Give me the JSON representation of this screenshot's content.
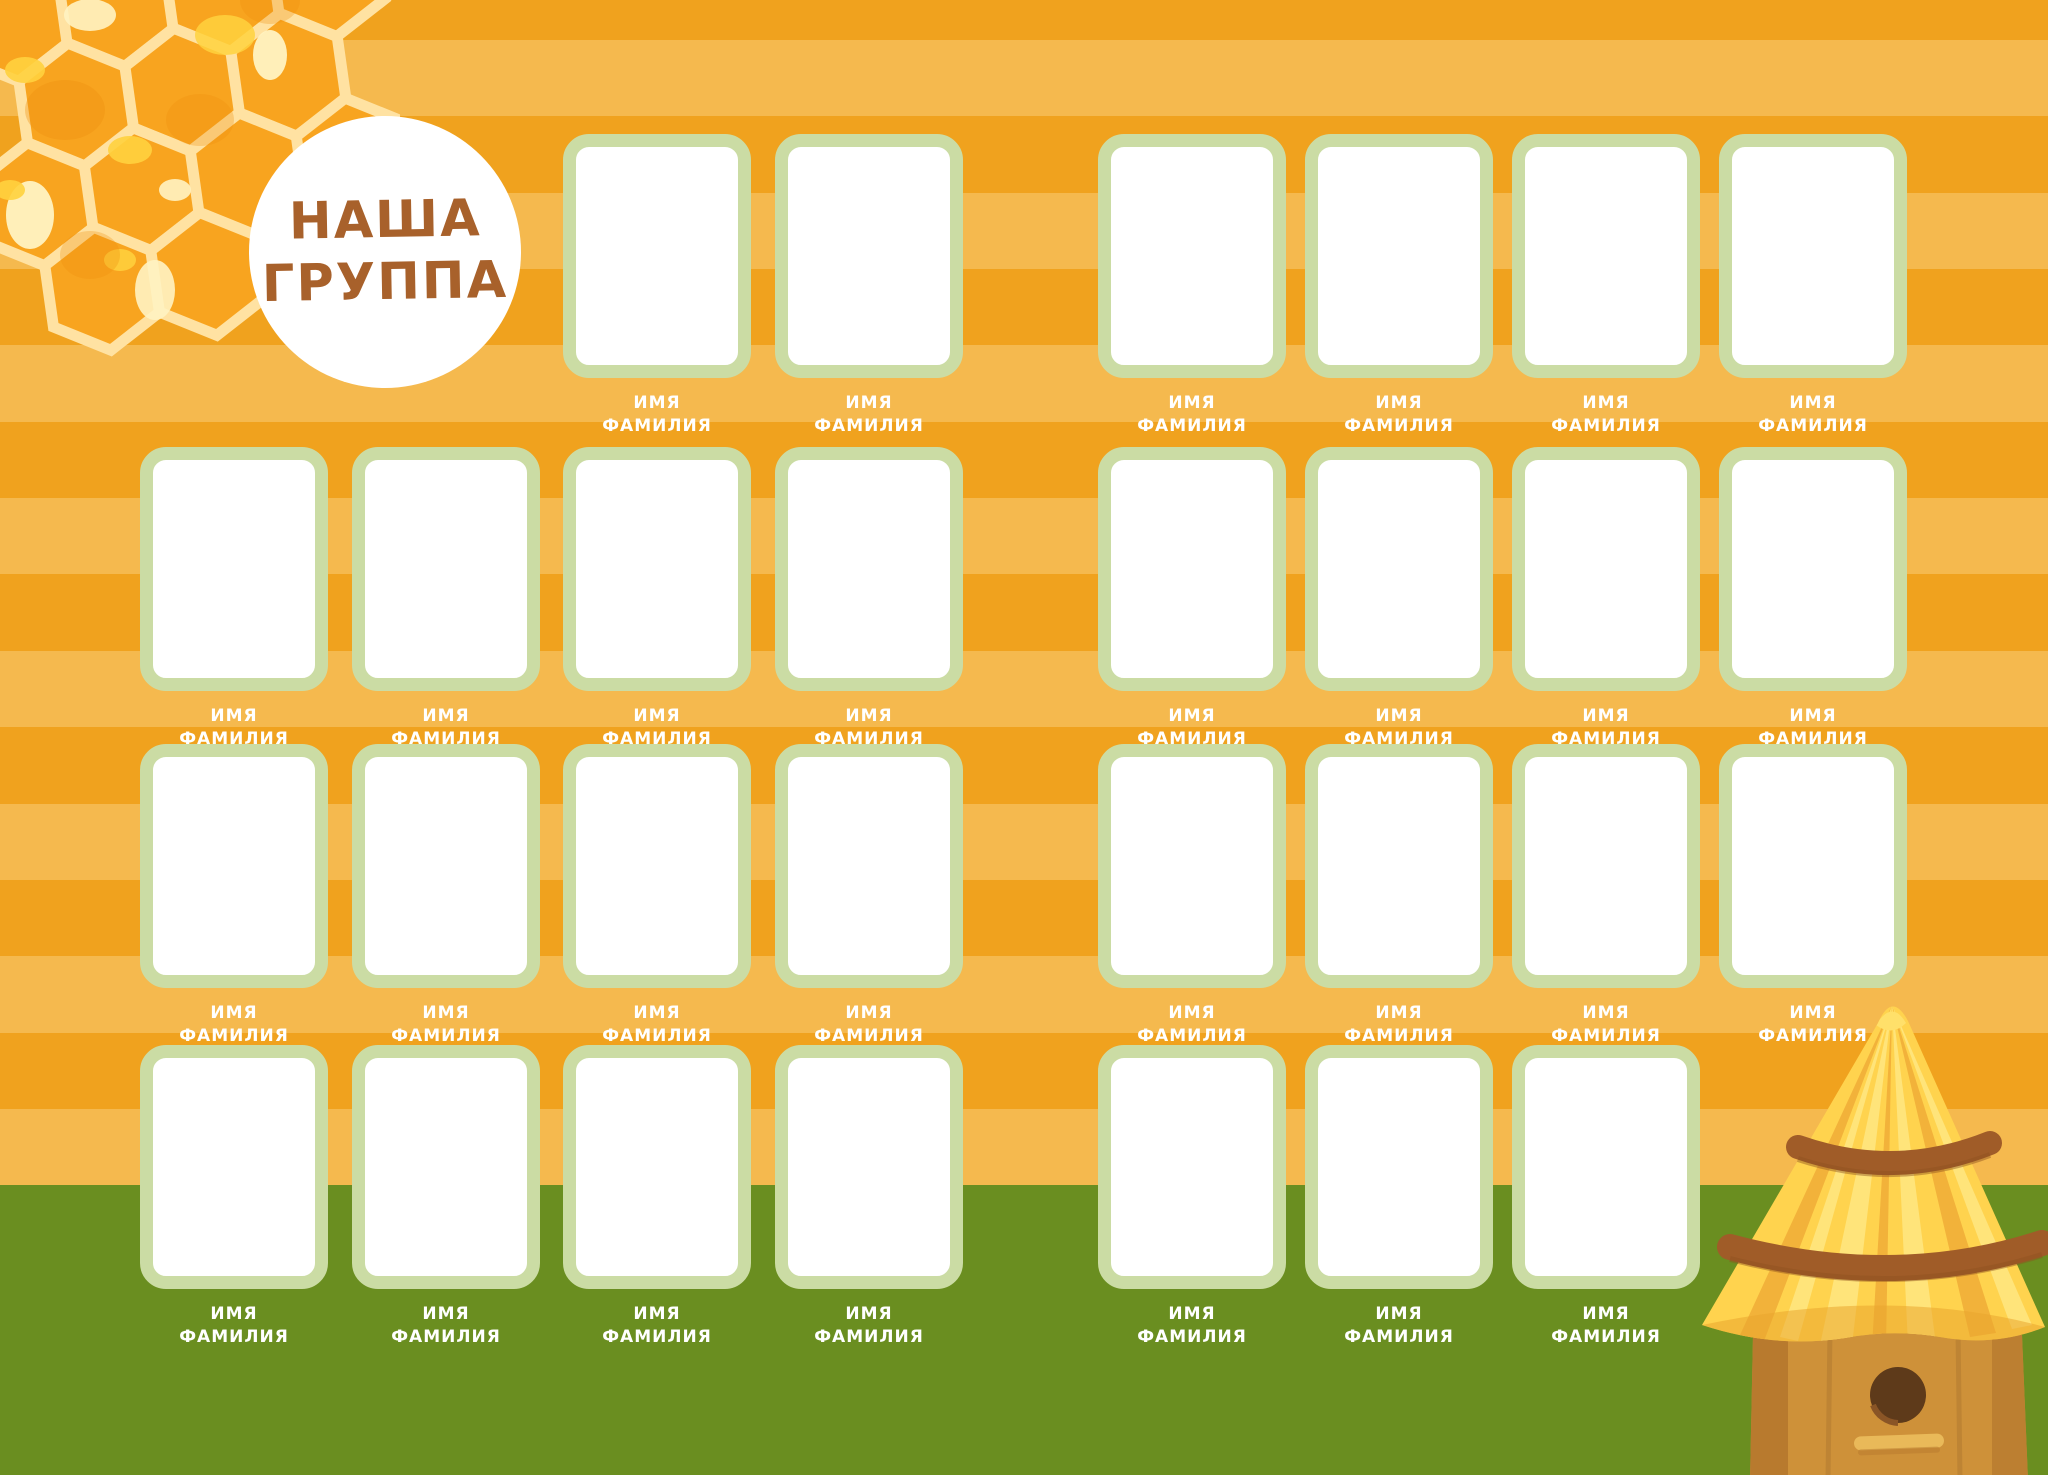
{
  "title": {
    "line1": "НАША",
    "line2": "ГРУППА"
  },
  "slot_label": {
    "line1": "ИМЯ",
    "line2": "ФАМИЛИЯ"
  },
  "grid": {
    "left": {
      "rows": [
        [
          3,
          4
        ],
        [
          1,
          2,
          3,
          4
        ],
        [
          1,
          2,
          3,
          4
        ],
        [
          1,
          2,
          3,
          4
        ]
      ]
    },
    "right": {
      "rows": [
        [
          1,
          2,
          3,
          4
        ],
        [
          1,
          2,
          3,
          4
        ],
        [
          1,
          2,
          3,
          4
        ],
        [
          1,
          2,
          3
        ]
      ]
    }
  },
  "slot_count": 29,
  "colors": {
    "stripe_dark": "#F0A21E",
    "stripe_light": "#F5B94E",
    "ground_green": "#6A8E20",
    "frame_border": "#CBDCA4",
    "frame_fill": "#FFFFFF",
    "title_text": "#A8612B",
    "label_text": "#FFFFFF",
    "honey_fill": "#F8A41F",
    "honey_border": "#FFE2A2",
    "honey_highlight": "#FFF3C2",
    "honey_accent": "#FFD23E",
    "honey_shade": "#EE8E0E",
    "hive_roof": "#FFD34E",
    "hive_roof_light": "#FFE47A",
    "hive_roof_shade": "#F2B23A",
    "hive_band": "#A05C28",
    "hive_body": "#CE9139",
    "hive_body_dark": "#B87A2E",
    "hive_hole": "#5E3A1A",
    "hive_perch": "#E9B959"
  },
  "decor": {
    "honeycomb": "honeycomb-illustration",
    "beehive": "beehive-illustration"
  }
}
